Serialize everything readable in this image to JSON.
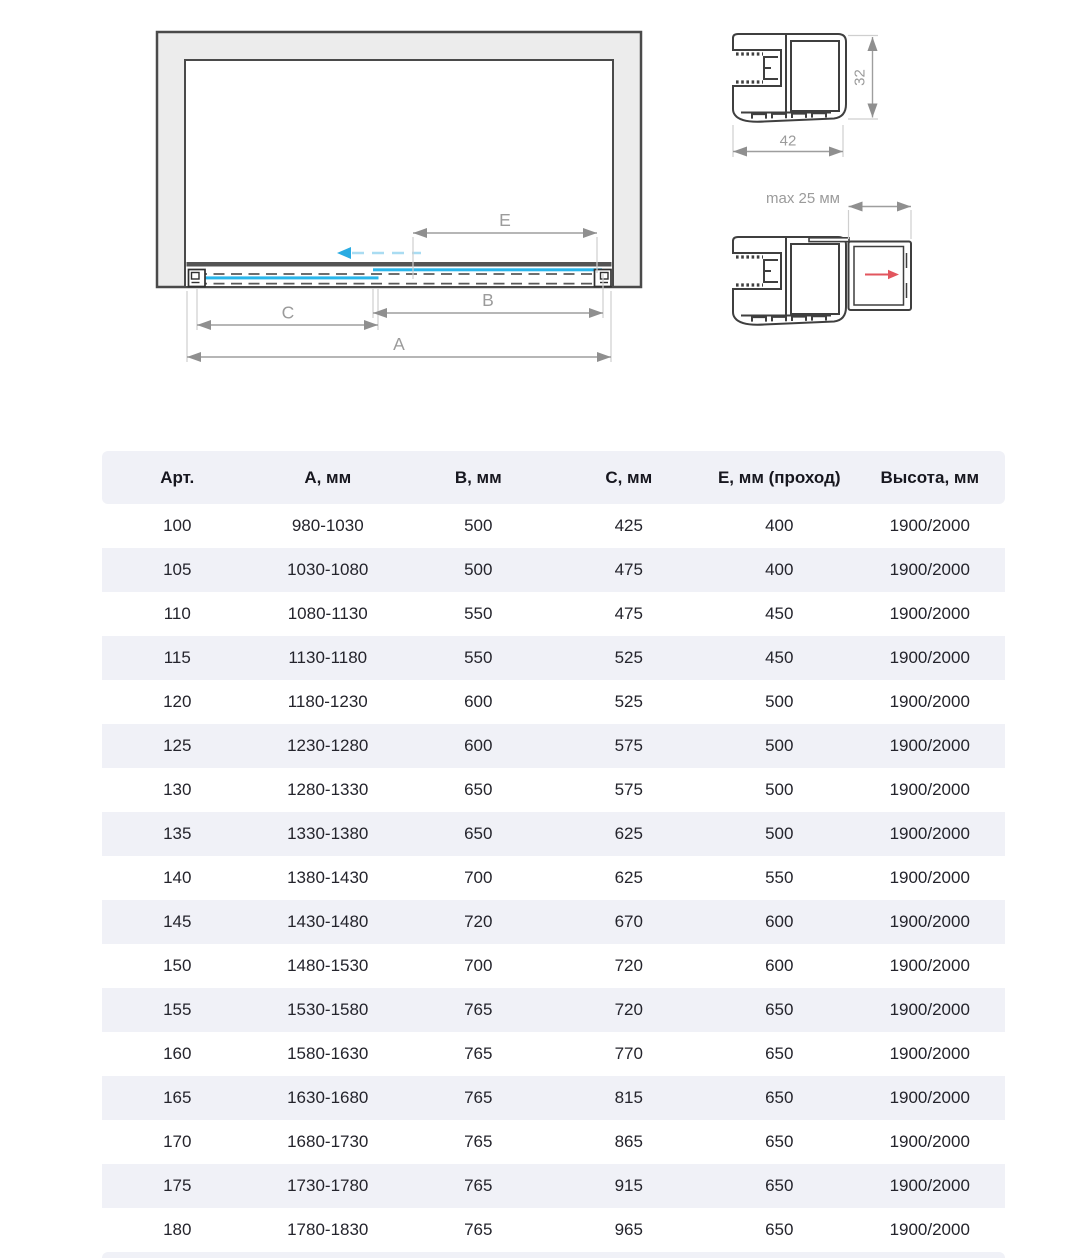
{
  "diagram": {
    "main_view": {
      "labels": {
        "a": "A",
        "b": "B",
        "c": "C",
        "e": "E"
      }
    },
    "profile_top": {
      "width_mm": "42",
      "height_mm": "32"
    },
    "profile_bottom": {
      "max_gap": "max 25 мм"
    },
    "colors": {
      "glass": "#29b5ea",
      "glass_arrow": "#29abe2",
      "glass_arrow_dash": "#a9dcf2",
      "extension_arrow_red": "#e2565e",
      "wall_fill": "#ececec",
      "outline": "#3f3f3f",
      "dimension_grey": "#9b9b9b",
      "track_dark": "#545454"
    }
  },
  "table": {
    "headers": [
      "Арт.",
      "А, мм",
      "В, мм",
      "С, мм",
      "Е, мм (проход)",
      "Высота, мм"
    ],
    "rows": [
      [
        "100",
        "980-1030",
        "500",
        "425",
        "400",
        "1900/2000"
      ],
      [
        "105",
        "1030-1080",
        "500",
        "475",
        "400",
        "1900/2000"
      ],
      [
        "110",
        "1080-1130",
        "550",
        "475",
        "450",
        "1900/2000"
      ],
      [
        "115",
        "1130-1180",
        "550",
        "525",
        "450",
        "1900/2000"
      ],
      [
        "120",
        "1180-1230",
        "600",
        "525",
        "500",
        "1900/2000"
      ],
      [
        "125",
        "1230-1280",
        "600",
        "575",
        "500",
        "1900/2000"
      ],
      [
        "130",
        "1280-1330",
        "650",
        "575",
        "500",
        "1900/2000"
      ],
      [
        "135",
        "1330-1380",
        "650",
        "625",
        "500",
        "1900/2000"
      ],
      [
        "140",
        "1380-1430",
        "700",
        "625",
        "550",
        "1900/2000"
      ],
      [
        "145",
        "1430-1480",
        "720",
        "670",
        "600",
        "1900/2000"
      ],
      [
        "150",
        "1480-1530",
        "700",
        "720",
        "600",
        "1900/2000"
      ],
      [
        "155",
        "1530-1580",
        "765",
        "720",
        "650",
        "1900/2000"
      ],
      [
        "160",
        "1580-1630",
        "765",
        "770",
        "650",
        "1900/2000"
      ],
      [
        "165",
        "1630-1680",
        "765",
        "815",
        "650",
        "1900/2000"
      ],
      [
        "170",
        "1680-1730",
        "765",
        "865",
        "650",
        "1900/2000"
      ],
      [
        "175",
        "1730-1780",
        "765",
        "915",
        "650",
        "1900/2000"
      ],
      [
        "180",
        "1780-1830",
        "765",
        "965",
        "650",
        "1900/2000"
      ]
    ],
    "stripe_color": "#f0f1f7"
  }
}
